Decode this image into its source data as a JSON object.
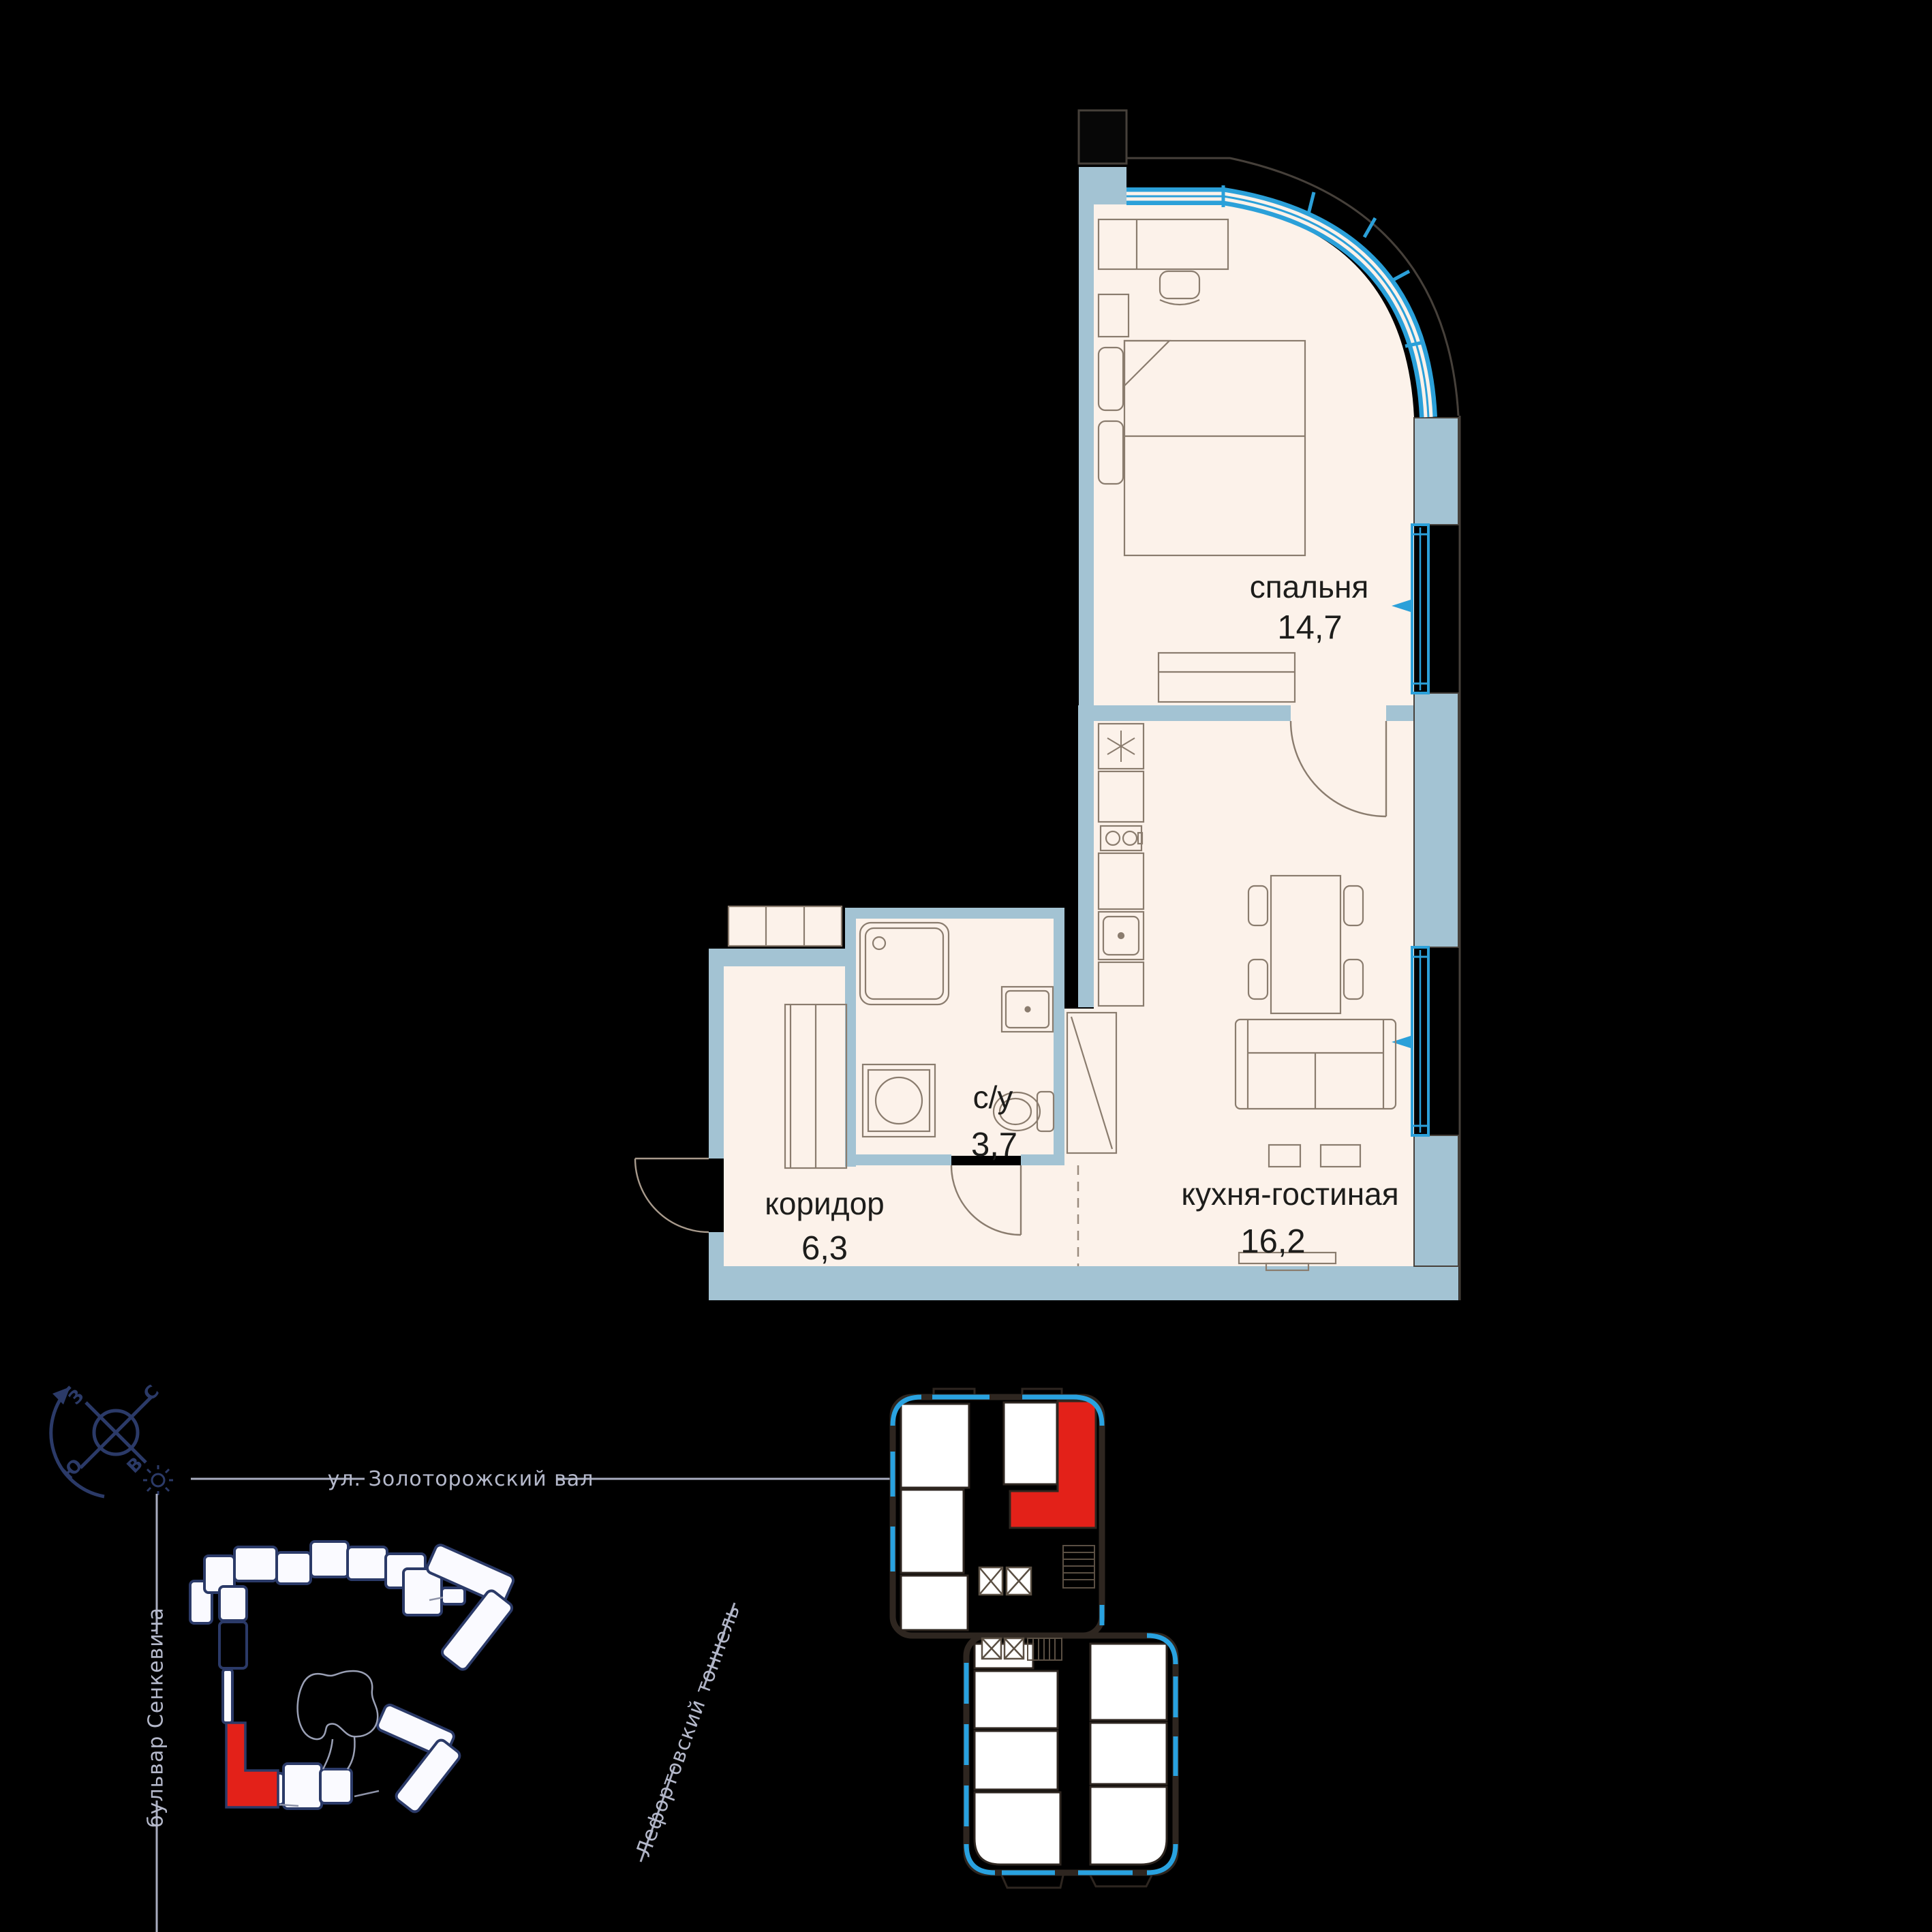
{
  "plan": {
    "title": "apartment floor plan",
    "rooms": [
      {
        "name": "спальня",
        "area": "14,7"
      },
      {
        "name": "с/у",
        "area": "3,7"
      },
      {
        "name": "коридор",
        "area": "6,3"
      },
      {
        "name": "кухня-гостиная",
        "area": "16,2"
      }
    ]
  },
  "site_map": {
    "streets": {
      "top": "ул. Золоторожский вал",
      "left": "бульвар Сенкевича",
      "diagonal": "Лефортовский тоннель"
    },
    "compass": {
      "n": "С",
      "s": "Ю",
      "w": "З",
      "e": "В"
    }
  },
  "colors": {
    "background": "#000000",
    "interior_cream": "#fcf2ea",
    "wall_blue_gray": "#a3c3d3",
    "window_blue": "#2ba0d9",
    "facade_line": "#46403a",
    "furniture_line": "#8a7c6e",
    "label_text": "#1d1d1b",
    "navy": "#2b3a68",
    "street_gray": "#b5b9cb",
    "plate_wall": "#2e2620",
    "highlight_red": "#e32119"
  }
}
